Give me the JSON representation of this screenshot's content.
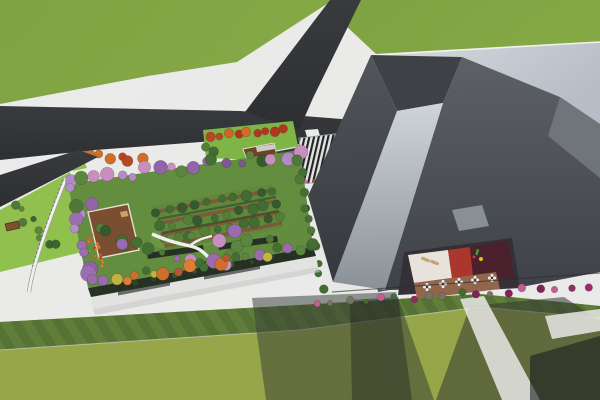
{
  "scene": {
    "title": "Aerial 3D architectural rendering",
    "description": "Bird's-eye render of a rooftop-garden building beside a large angular gray tower, with an asphalt road junction, striped entrance plaza, courtyard terrace with cafe tables, flower bushes and shadowed lawns",
    "elements": [
      "grass field",
      "asphalt Y-road junction",
      "rooftop garden with orchard rows",
      "winding garden path",
      "wooden deck pavilion",
      "red flower patch",
      "small park with red trees and shelters",
      "zebra-striped plaza",
      "angular gray tower with light rim",
      "inclined light facade panel",
      "courtyard with cafe tables, benches and playground",
      "magenta flower bushes",
      "mowed lawn stripes",
      "building shadows"
    ]
  },
  "palette": {
    "pavement": "#ebecea",
    "asphalt": "#2b2d30",
    "grass_top": "#7ca33c",
    "lawn_bottom": "#99a844",
    "garden_lawn": "#5f8a39",
    "park_lawn": "#7cb340",
    "strip_lawn": "#8ebf48",
    "orchard_soil": "#7b5332",
    "deck_wood": "#77492a",
    "rim_light": "#ccd1d8",
    "tower_dark": "#44484c",
    "wing_roof": "#e9eae7",
    "plaza_dark": "#1a1b1d",
    "plaza_light": "#e3e4e2",
    "courtyard_white": "#e9e4dc",
    "courtyard_red": "#a93028",
    "courtyard_maroon": "#451a26",
    "terrace_brown": "#8f6247",
    "parapet_hedge": "#1f2a1c",
    "shadow": "#2e332c",
    "bush_magenta": "#a02468"
  },
  "tree_clusters": [
    {
      "name": "garden-top-border",
      "item": "tree",
      "from": [
        74,
        181
      ],
      "to": [
        296,
        153
      ],
      "count": 20,
      "spread": 5,
      "rmin": 3.5,
      "rmax": 7,
      "colors": [
        "#8f5fa8",
        "#b287c6",
        "#3f6b2e",
        "#57823a",
        "#c98bbf",
        "#2f5526",
        "#7d5294"
      ]
    },
    {
      "name": "garden-left-border",
      "item": "tree",
      "from": [
        72,
        190
      ],
      "to": [
        88,
        278
      ],
      "count": 8,
      "spread": 5,
      "rmin": 4,
      "rmax": 8,
      "colors": [
        "#9a6bb0",
        "#7d5294",
        "#4a7433",
        "#b38cc4",
        "#8f5fa8"
      ]
    },
    {
      "name": "garden-bottom-border",
      "item": "tree",
      "from": [
        94,
        283
      ],
      "to": [
        310,
        246
      ],
      "count": 22,
      "spread": 4,
      "rmin": 3.5,
      "rmax": 6.5,
      "colors": [
        "#3f6b2e",
        "#d06a27",
        "#9a67ad",
        "#c2b13a",
        "#57823a",
        "#b5512a",
        "#7aa03c",
        "#e07a2e"
      ]
    },
    {
      "name": "garden-right-border",
      "item": "tree",
      "from": [
        298,
        158
      ],
      "to": [
        312,
        242
      ],
      "count": 8,
      "spread": 3,
      "rmin": 3.5,
      "rmax": 5.5,
      "colors": [
        "#3f6b2e",
        "#57823a",
        "#8f5fa8",
        "#4a7433"
      ]
    },
    {
      "name": "orchard-row-1",
      "item": "orchard-tree",
      "from": [
        156,
        212
      ],
      "to": [
        274,
        190
      ],
      "count": 10,
      "spread": 2.5,
      "rmin": 3.5,
      "rmax": 5.5,
      "colors": [
        "#3c682c",
        "#2f5526",
        "#4f7c31"
      ]
    },
    {
      "name": "orchard-row-2",
      "item": "orchard-tree",
      "from": [
        160,
        226
      ],
      "to": [
        278,
        204
      ],
      "count": 10,
      "spread": 2.5,
      "rmin": 3.5,
      "rmax": 5.5,
      "colors": [
        "#3c682c",
        "#2f5526",
        "#4f7c31"
      ]
    },
    {
      "name": "orchard-row-3",
      "item": "orchard-tree",
      "from": [
        164,
        240
      ],
      "to": [
        281,
        218
      ],
      "count": 10,
      "spread": 2.5,
      "rmin": 3.5,
      "rmax": 5.5,
      "colors": [
        "#3c682c",
        "#2f5526",
        "#4f7c31"
      ]
    },
    {
      "name": "garden-scatter",
      "item": "tree",
      "from": [
        122,
        256
      ],
      "to": [
        272,
        238
      ],
      "count": 13,
      "spread": 13,
      "rmin": 3,
      "rmax": 7,
      "colors": [
        "#4a7433",
        "#9a67ad",
        "#c98bbf",
        "#3f6b2e",
        "#b287c6",
        "#57823a"
      ]
    },
    {
      "name": "deck-trees",
      "item": "tree",
      "from": [
        100,
        224
      ],
      "to": [
        126,
        242
      ],
      "count": 4,
      "spread": 6,
      "rmin": 4.5,
      "rmax": 6.5,
      "colors": [
        "#3c682c",
        "#2f5526",
        "#4f7c31"
      ]
    },
    {
      "name": "north-strip-trees",
      "item": "tree",
      "from": [
        72,
        152
      ],
      "to": [
        140,
        161
      ],
      "count": 8,
      "spread": 3,
      "rmin": 3.5,
      "rmax": 5.5,
      "colors": [
        "#b5431c",
        "#d06a22",
        "#2f5526",
        "#c2391d"
      ]
    },
    {
      "name": "park-red-row",
      "item": "tree",
      "from": [
        210,
        137
      ],
      "to": [
        284,
        129
      ],
      "count": 9,
      "spread": 2,
      "rmin": 3.5,
      "rmax": 5,
      "colors": [
        "#b5431c",
        "#d06a22",
        "#b03018",
        "#c9611f"
      ]
    },
    {
      "name": "park-green",
      "item": "tree",
      "from": [
        205,
        148
      ],
      "to": [
        215,
        153
      ],
      "count": 2,
      "spread": 2,
      "rmin": 4,
      "rmax": 5,
      "colors": [
        "#3c682c",
        "#4f7c31"
      ]
    },
    {
      "name": "wing-edge-row",
      "item": "shrub",
      "from": [
        301,
        194
      ],
      "to": [
        323,
        288
      ],
      "count": 8,
      "spread": 2.5,
      "rmin": 3,
      "rmax": 4.5,
      "colors": [
        "#2f5526",
        "#3c682c",
        "#24401f"
      ]
    },
    {
      "name": "parapet-bushes",
      "item": "hedge-bush",
      "from": [
        96,
        289
      ],
      "to": [
        310,
        250
      ],
      "count": 12,
      "spread": 1.5,
      "rmin": 1.8,
      "rmax": 3.2,
      "colors": [
        "#24401f",
        "#2e5226",
        "#1d3418"
      ],
      "stroke": false
    },
    {
      "name": "base-bushes",
      "item": "flower-bush",
      "from": [
        316,
        303
      ],
      "to": [
        588,
        286
      ],
      "count": 18,
      "spread": 2.5,
      "rmin": 2.2,
      "rmax": 4.2,
      "colors": [
        "#a02468",
        "#8f2560",
        "#c05a92",
        "#3d6b2d",
        "#75715f",
        "#c8b22a",
        "#7d1d52"
      ]
    },
    {
      "name": "left-strip-bushes",
      "item": "shrub",
      "from": [
        12,
        206
      ],
      "to": [
        58,
        246
      ],
      "count": 8,
      "spread": 6,
      "rmin": 2.5,
      "rmax": 4.5,
      "colors": [
        "#4a7433",
        "#57823a",
        "#35602a"
      ]
    },
    {
      "name": "red-flower-patch",
      "item": "flower",
      "from": [
        88,
        238
      ],
      "to": [
        102,
        266
      ],
      "count": 22,
      "spread": 6,
      "rmin": 0.9,
      "rmax": 1.8,
      "colors": [
        "#c2391d",
        "#d9571f",
        "#e2742a"
      ],
      "stroke": false
    },
    {
      "name": "plaza-flowers",
      "item": "flower",
      "from": [
        305,
        183
      ],
      "to": [
        356,
        175
      ],
      "count": 6,
      "spread": 1.5,
      "rmin": 1.2,
      "rmax": 2,
      "colors": [
        "#c96fa8",
        "#b5431c",
        "#4a7a2e",
        "#d06a22"
      ],
      "stroke": false
    },
    {
      "name": "crosswalk-flowers",
      "item": "flower",
      "from": [
        303,
        140
      ],
      "to": [
        340,
        137
      ],
      "count": 5,
      "spread": 1.5,
      "rmin": 1,
      "rmax": 1.8,
      "colors": [
        "#4a9a2e",
        "#c2391d"
      ],
      "stroke": false
    }
  ],
  "courtyard_tables": [
    [
      427,
      287
    ],
    [
      443,
      284
    ],
    [
      459,
      282
    ],
    [
      475,
      280
    ],
    [
      492,
      278
    ]
  ]
}
